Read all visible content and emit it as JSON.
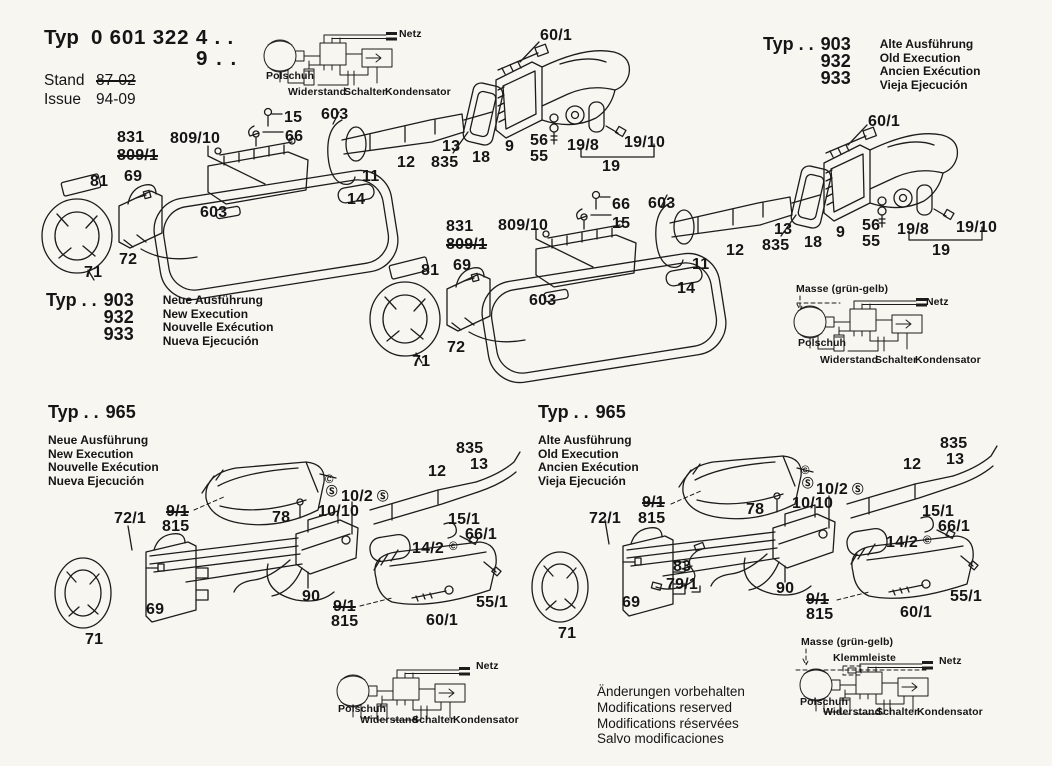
{
  "title_block": {
    "typ_label": "Typ",
    "typ_number": "0 601 322 4 . .",
    "typ_number_line2": "9 . .",
    "stand_label": "Stand",
    "stand_value": "87-02",
    "issue_label": "Issue",
    "issue_value": "94-09"
  },
  "type_blocks": [
    {
      "typ_prefix": "Typ . .",
      "numbers": [
        "903",
        "932",
        "933"
      ],
      "variant_lines": [
        "Alte Ausführung",
        "Old Execution",
        "Ancien Exécution",
        "Vieja Ejecución"
      ]
    },
    {
      "typ_prefix": "Typ . .",
      "numbers": [
        "903",
        "932",
        "933"
      ],
      "variant_lines": [
        "Neue Ausführung",
        "New Execution",
        "Nouvelle Exécution",
        "Nueva Ejecución"
      ]
    },
    {
      "typ_prefix": "Typ . .",
      "numbers": [
        "965"
      ],
      "variant_lines": [
        "Neue Ausführung",
        "New Execution",
        "Nouvelle Exécution",
        "Nueva Ejecución"
      ]
    },
    {
      "typ_prefix": "Typ . .",
      "numbers": [
        "965"
      ],
      "variant_lines": [
        "Alte Ausführung",
        "Old Execution",
        "Ancien Exécution",
        "Vieja Ejecución"
      ]
    }
  ],
  "part_labels": [
    {
      "t": "60/1",
      "x": 540,
      "y": 28
    },
    {
      "t": "831",
      "x": 117,
      "y": 130
    },
    {
      "t": "809/1",
      "x": 117,
      "y": 148,
      "strike": true
    },
    {
      "t": "809/10",
      "x": 170,
      "y": 131
    },
    {
      "t": "15",
      "x": 284,
      "y": 110
    },
    {
      "t": "66",
      "x": 285,
      "y": 129
    },
    {
      "t": "603",
      "x": 321,
      "y": 107
    },
    {
      "t": "12",
      "x": 397,
      "y": 155
    },
    {
      "t": "11",
      "x": 362,
      "y": 169
    },
    {
      "t": "14",
      "x": 347,
      "y": 192
    },
    {
      "t": "13",
      "x": 442,
      "y": 139
    },
    {
      "t": "835",
      "x": 431,
      "y": 155
    },
    {
      "t": "18",
      "x": 472,
      "y": 150
    },
    {
      "t": "9",
      "x": 505,
      "y": 139
    },
    {
      "t": "56",
      "x": 530,
      "y": 133
    },
    {
      "t": "55",
      "x": 530,
      "y": 149
    },
    {
      "t": "19/8",
      "x": 567,
      "y": 138
    },
    {
      "t": "19/10",
      "x": 624,
      "y": 135
    },
    {
      "t": "19",
      "x": 602,
      "y": 159
    },
    {
      "t": "81",
      "x": 90,
      "y": 174
    },
    {
      "t": "69",
      "x": 124,
      "y": 169
    },
    {
      "t": "603",
      "x": 200,
      "y": 205
    },
    {
      "t": "72",
      "x": 119,
      "y": 252
    },
    {
      "t": "71",
      "x": 84,
      "y": 265
    },
    {
      "t": "66",
      "x": 612,
      "y": 197
    },
    {
      "t": "15",
      "x": 612,
      "y": 216
    },
    {
      "t": "603",
      "x": 648,
      "y": 196
    },
    {
      "t": "831",
      "x": 446,
      "y": 219
    },
    {
      "t": "809/1",
      "x": 446,
      "y": 237,
      "strike": true
    },
    {
      "t": "809/10",
      "x": 498,
      "y": 218
    },
    {
      "t": "69",
      "x": 453,
      "y": 258
    },
    {
      "t": "81",
      "x": 421,
      "y": 263
    },
    {
      "t": "603",
      "x": 529,
      "y": 293
    },
    {
      "t": "72",
      "x": 447,
      "y": 340
    },
    {
      "t": "71",
      "x": 412,
      "y": 354
    },
    {
      "t": "12",
      "x": 726,
      "y": 243
    },
    {
      "t": "11",
      "x": 692,
      "y": 257
    },
    {
      "t": "14",
      "x": 677,
      "y": 281
    },
    {
      "t": "13",
      "x": 774,
      "y": 222
    },
    {
      "t": "835",
      "x": 762,
      "y": 238
    },
    {
      "t": "18",
      "x": 804,
      "y": 235
    },
    {
      "t": "9",
      "x": 836,
      "y": 225
    },
    {
      "t": "56",
      "x": 862,
      "y": 218
    },
    {
      "t": "55",
      "x": 862,
      "y": 234
    },
    {
      "t": "19/8",
      "x": 897,
      "y": 222
    },
    {
      "t": "19/10",
      "x": 956,
      "y": 220
    },
    {
      "t": "19",
      "x": 932,
      "y": 243
    },
    {
      "t": "60/1",
      "x": 868,
      "y": 114
    },
    {
      "t": "835",
      "x": 456,
      "y": 441
    },
    {
      "t": "13",
      "x": 470,
      "y": 457
    },
    {
      "t": "12",
      "x": 428,
      "y": 464
    },
    {
      "t": "©",
      "x": 325,
      "y": 475,
      "kind": "sym"
    },
    {
      "t": "Ⓢ",
      "x": 326,
      "y": 487,
      "kind": "sym"
    },
    {
      "t": "10/2",
      "x": 341,
      "y": 489
    },
    {
      "t": "Ⓢ",
      "x": 377,
      "y": 492,
      "kind": "sym"
    },
    {
      "t": "10/10",
      "x": 318,
      "y": 504
    },
    {
      "t": "9/1",
      "x": 166,
      "y": 504,
      "strike": true
    },
    {
      "t": "815",
      "x": 162,
      "y": 519
    },
    {
      "t": "78",
      "x": 272,
      "y": 510
    },
    {
      "t": "72/1",
      "x": 114,
      "y": 511
    },
    {
      "t": "15/1",
      "x": 448,
      "y": 512
    },
    {
      "t": "66/1",
      "x": 465,
      "y": 527
    },
    {
      "t": "14/2",
      "x": 412,
      "y": 541
    },
    {
      "t": "©",
      "x": 449,
      "y": 542,
      "kind": "sym"
    },
    {
      "t": "90",
      "x": 302,
      "y": 589
    },
    {
      "t": "9/1",
      "x": 333,
      "y": 599,
      "strike": true
    },
    {
      "t": "815",
      "x": 331,
      "y": 614
    },
    {
      "t": "60/1",
      "x": 426,
      "y": 613
    },
    {
      "t": "55/1",
      "x": 476,
      "y": 595
    },
    {
      "t": "69",
      "x": 146,
      "y": 602
    },
    {
      "t": "71",
      "x": 85,
      "y": 632
    },
    {
      "t": "835",
      "x": 940,
      "y": 436
    },
    {
      "t": "13",
      "x": 946,
      "y": 452
    },
    {
      "t": "12",
      "x": 903,
      "y": 457
    },
    {
      "t": "©",
      "x": 801,
      "y": 466,
      "kind": "sym"
    },
    {
      "t": "Ⓢ",
      "x": 802,
      "y": 479,
      "kind": "sym"
    },
    {
      "t": "10/2",
      "x": 816,
      "y": 482
    },
    {
      "t": "Ⓢ",
      "x": 852,
      "y": 485,
      "kind": "sym"
    },
    {
      "t": "10/10",
      "x": 792,
      "y": 496
    },
    {
      "t": "9/1",
      "x": 642,
      "y": 495,
      "strike": true
    },
    {
      "t": "815",
      "x": 638,
      "y": 511
    },
    {
      "t": "78",
      "x": 746,
      "y": 502
    },
    {
      "t": "72/1",
      "x": 589,
      "y": 511
    },
    {
      "t": "15/1",
      "x": 922,
      "y": 504
    },
    {
      "t": "66/1",
      "x": 938,
      "y": 519
    },
    {
      "t": "14/2",
      "x": 886,
      "y": 535
    },
    {
      "t": "©",
      "x": 923,
      "y": 536,
      "kind": "sym"
    },
    {
      "t": "83",
      "x": 673,
      "y": 559
    },
    {
      "t": "79/1",
      "x": 666,
      "y": 577
    },
    {
      "t": "90",
      "x": 776,
      "y": 581
    },
    {
      "t": "9/1",
      "x": 806,
      "y": 592,
      "strike": true
    },
    {
      "t": "815",
      "x": 806,
      "y": 607
    },
    {
      "t": "60/1",
      "x": 900,
      "y": 605
    },
    {
      "t": "55/1",
      "x": 950,
      "y": 589
    },
    {
      "t": "69",
      "x": 622,
      "y": 595
    },
    {
      "t": "71",
      "x": 558,
      "y": 626
    }
  ],
  "wiring_labels": [
    {
      "t": "Netz",
      "x": 399,
      "y": 29
    },
    {
      "t": "Polschuh",
      "x": 266,
      "y": 71
    },
    {
      "t": "Widerstand",
      "x": 288,
      "y": 87
    },
    {
      "t": "Schalter",
      "x": 344,
      "y": 87
    },
    {
      "t": "Kondensator",
      "x": 385,
      "y": 87
    },
    {
      "t": "Masse (grün-gelb)",
      "x": 796,
      "y": 284
    },
    {
      "t": "Netz",
      "x": 926,
      "y": 297
    },
    {
      "t": "Polschuh",
      "x": 798,
      "y": 338
    },
    {
      "t": "Widerstand",
      "x": 820,
      "y": 355
    },
    {
      "t": "Schalter",
      "x": 875,
      "y": 355
    },
    {
      "t": "Kondensator",
      "x": 915,
      "y": 355
    },
    {
      "t": "Netz",
      "x": 476,
      "y": 661
    },
    {
      "t": "Polschuh",
      "x": 338,
      "y": 704
    },
    {
      "t": "Widerstand",
      "x": 360,
      "y": 715
    },
    {
      "t": "Schalter",
      "x": 412,
      "y": 715
    },
    {
      "t": "Kondensator",
      "x": 453,
      "y": 715
    },
    {
      "t": "Masse (grün-gelb)",
      "x": 801,
      "y": 637
    },
    {
      "t": "Klemmleiste",
      "x": 833,
      "y": 653
    },
    {
      "t": "Netz",
      "x": 939,
      "y": 656
    },
    {
      "t": "Polschuh",
      "x": 800,
      "y": 697
    },
    {
      "t": "Widerstand",
      "x": 823,
      "y": 707
    },
    {
      "t": "Schalter",
      "x": 876,
      "y": 707
    },
    {
      "t": "Kondensator",
      "x": 917,
      "y": 707
    }
  ],
  "footer_notes": [
    "Änderungen vorbehalten",
    "Modifications reserved",
    "Modifications réservées",
    "Salvo modificaciones"
  ],
  "colors": {
    "ink": "#1c1c1c",
    "paper": "#f7f6f1"
  }
}
